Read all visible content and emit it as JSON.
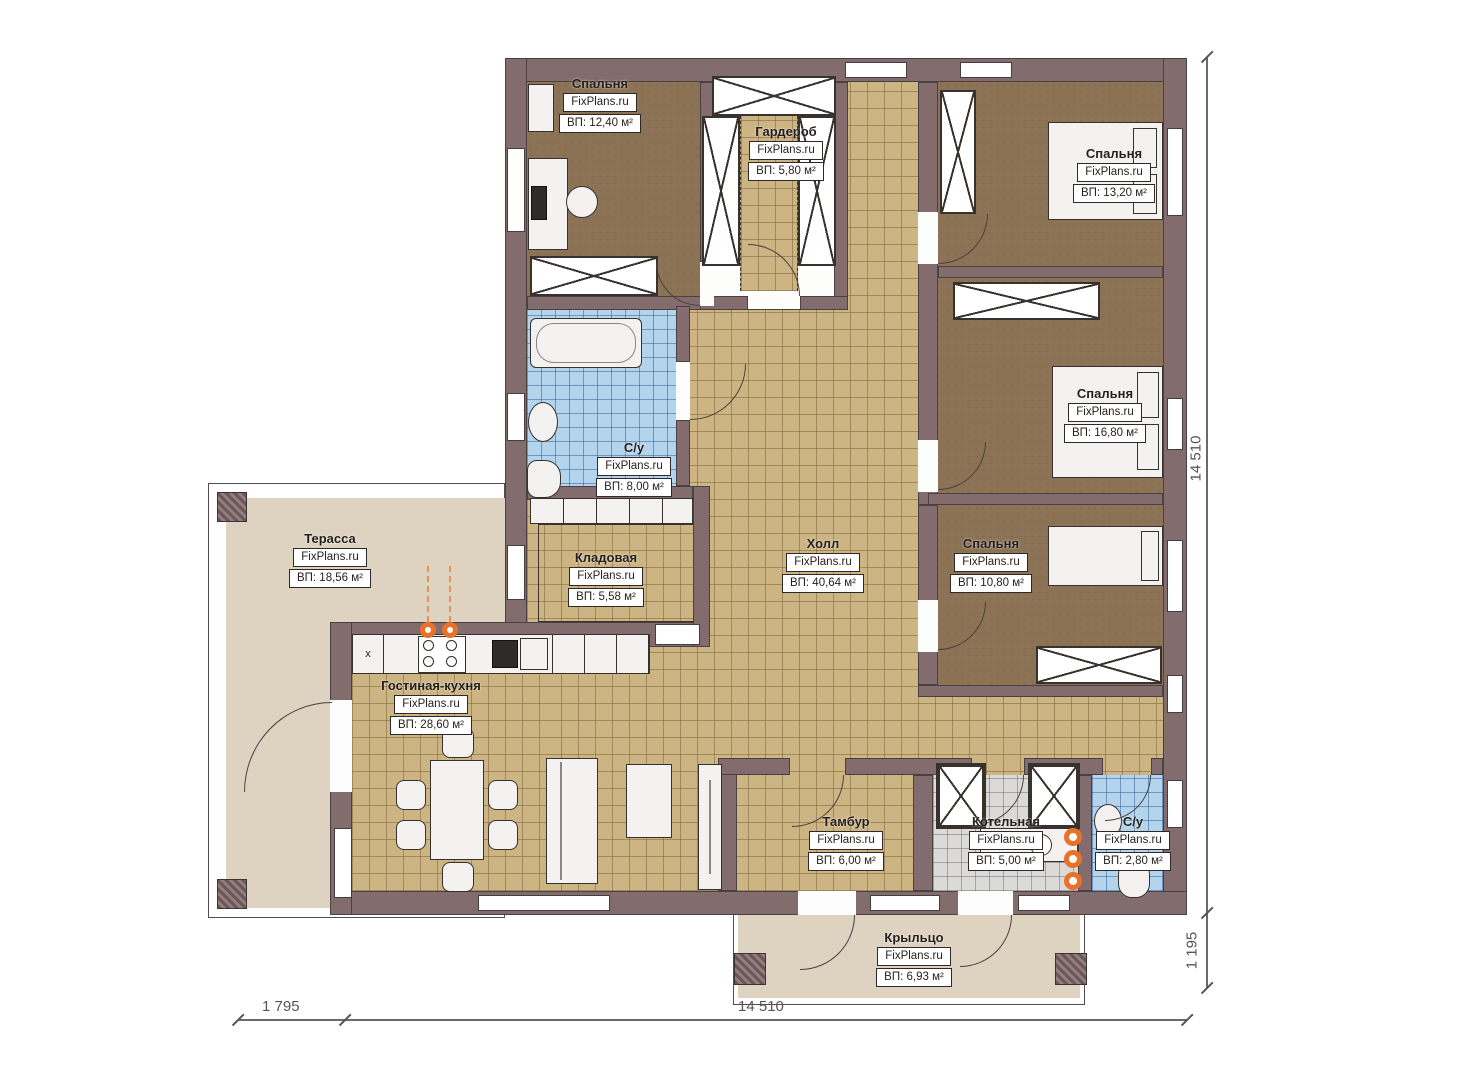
{
  "plan": {
    "watermark": "FixPlans.ru",
    "rooms": [
      {
        "id": "bedroom_tl",
        "name": "Спальня",
        "area": "ВП: 12,40 м²"
      },
      {
        "id": "wardrobe",
        "name": "Гардероб",
        "area": "ВП: 5,80 м²"
      },
      {
        "id": "bedroom_tr",
        "name": "Спальня",
        "area": "ВП: 13,20 м²"
      },
      {
        "id": "bedroom_mr",
        "name": "Спальня",
        "area": "ВП: 16,80 м²"
      },
      {
        "id": "bedroom_br",
        "name": "Спальня",
        "area": "ВП: 10,80 м²"
      },
      {
        "id": "bath_main",
        "name": "С/у",
        "area": "ВП: 8,00 м²"
      },
      {
        "id": "storage",
        "name": "Кладовая",
        "area": "ВП: 5,58 м²"
      },
      {
        "id": "hall",
        "name": "Холл",
        "area": "ВП: 40,64 м²"
      },
      {
        "id": "terrace",
        "name": "Терасса",
        "area": "ВП: 18,56 м²"
      },
      {
        "id": "living",
        "name": "Гостиная-кухня",
        "area": "ВП: 28,60 м²"
      },
      {
        "id": "tambur",
        "name": "Тамбур",
        "area": "ВП: 6,00 м²"
      },
      {
        "id": "boiler",
        "name": "Котельная",
        "area": "ВП: 5,00 м²"
      },
      {
        "id": "bath_small",
        "name": "С/у",
        "area": "ВП: 2,80 м²"
      },
      {
        "id": "porch",
        "name": "Крыльцо",
        "area": "ВП: 6,93 м²"
      }
    ],
    "dimensions": {
      "right_main": "14 510",
      "right_porch": "1 195",
      "bottom_terrace": "1 795",
      "bottom_main": "14 510"
    },
    "misc": {
      "kitchen_sink_mark": "x"
    },
    "colors": {
      "wall": "#826c6e",
      "hall_tile": "#cdb483",
      "bath_tile": "#b4d3ec",
      "boiler_tile": "#dbdad8",
      "bedroom_floor": "#8c7356",
      "terrace": "#ded3c1",
      "accent_orange": "#e8722a"
    }
  }
}
